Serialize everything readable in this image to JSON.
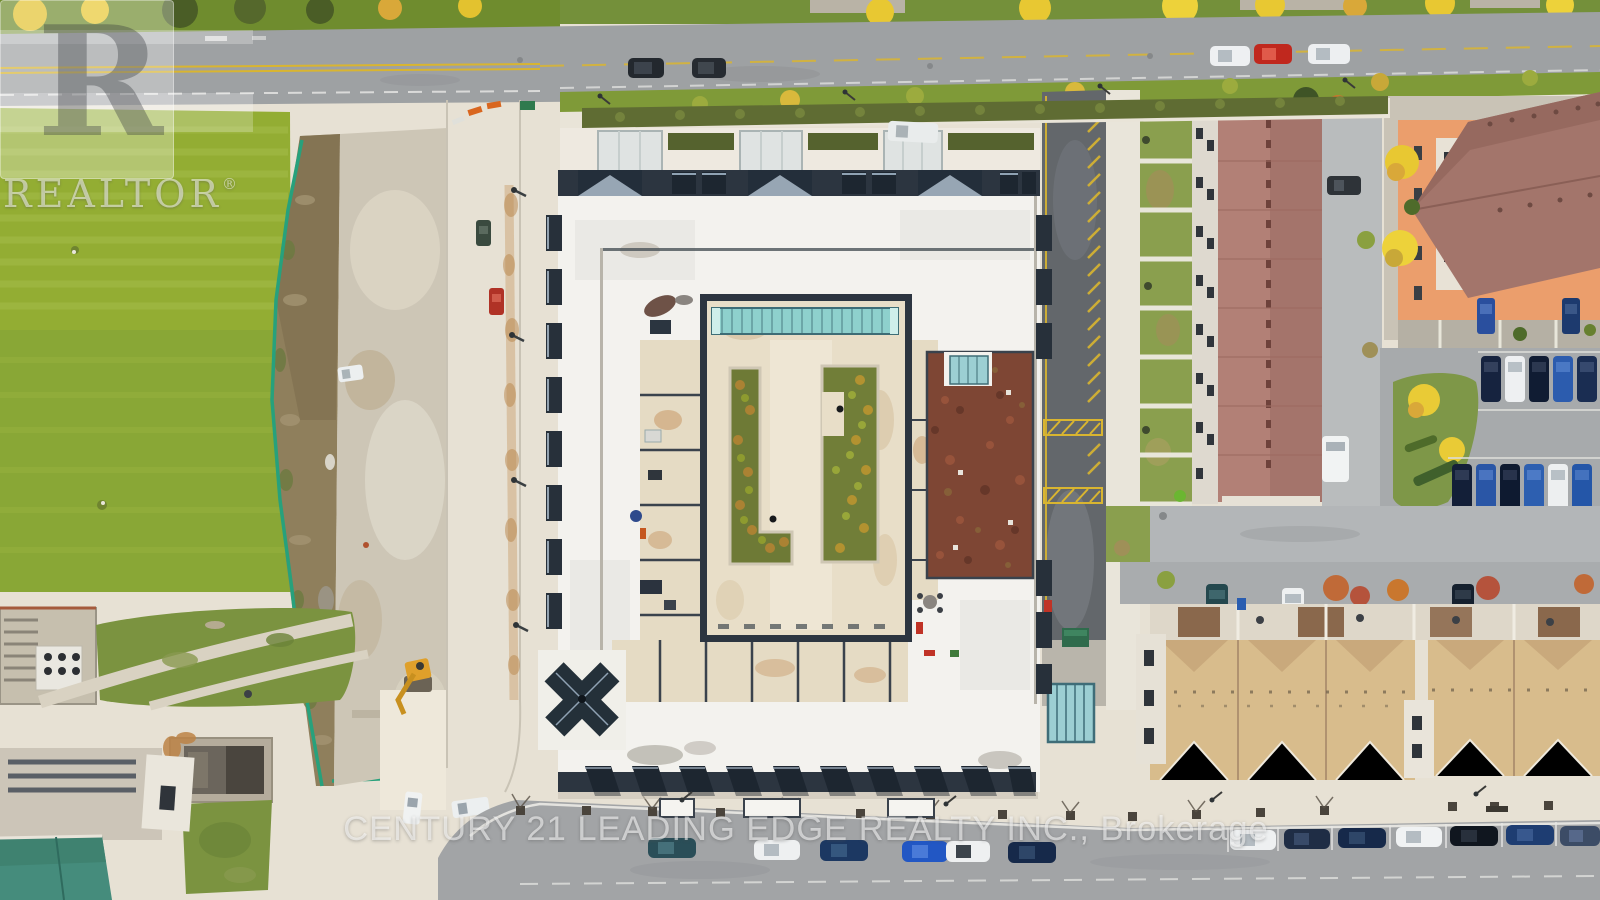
{
  "image": {
    "width": 1600,
    "height": 900,
    "kind": "aerial-drone-photo",
    "subject": "Top-down aerial view of a white-roofed condominium with interior courtyard, laneways, townhouse rows, parking lots, a construction lot and a green field"
  },
  "watermarks": {
    "logo_letter": "R",
    "logo_text": "REALTOR",
    "logo_registered_mark": "®",
    "brokerage_line": "CENTURY 21 LEADING EDGE REALTY INC., Brokerage"
  },
  "colors": {
    "condo_roof_white": "#f3f2ee",
    "roof_trim_navy": "#2c3540",
    "courtyard_pavers": "#e8dec8",
    "skylight_teal": "#8ed0cd",
    "sedum_green_roof": "#7e4634",
    "grass_field": "#93ad33",
    "lawn_green": "#7f9a38",
    "asphalt_road": "#9ea1a3",
    "laneway_asphalt": "#63676b",
    "hatch_yellow": "#d9b530",
    "plaza_concrete": "#e7e1d4",
    "dirt_strip": "#8f7f5c",
    "construction_fence": "#27a17c",
    "townhouse_roof_red": "#b28076",
    "townhouse_roof_tan": "#d8bc8c",
    "orange_building_wall": "#eb9e6c",
    "orange_building_roof": "#a3756b",
    "autumn_tree_yellow": "#e8c832",
    "watermark_white": "rgba(255,255,255,0.55)"
  }
}
